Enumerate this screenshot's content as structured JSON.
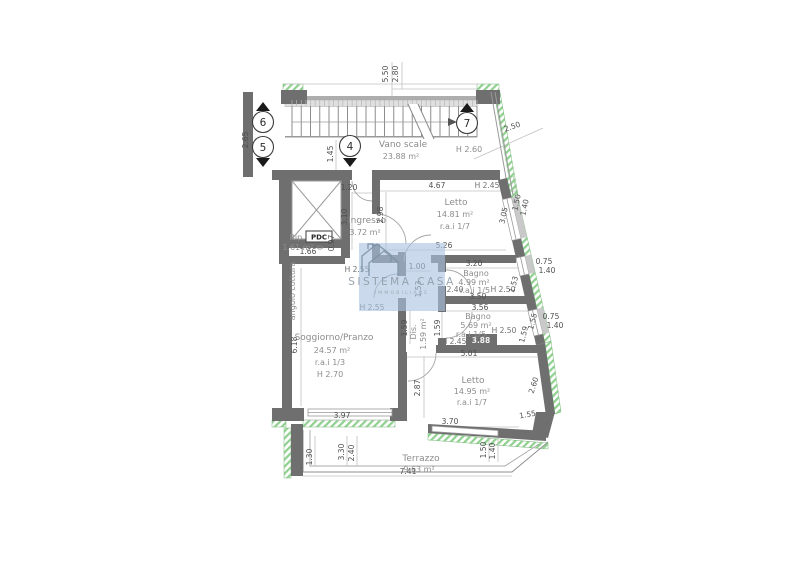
{
  "watermark": {
    "title": "SISTEMA CASA",
    "subtitle": "IMMOBILIARE"
  },
  "colors": {
    "wall": "#6f6f6f",
    "hatch_green": "#8fd08f",
    "watermark_bg": "#aac3e0",
    "dim_text": "#4f4f4f",
    "room_text": "#8c8c8c"
  },
  "stair": {
    "markers": [
      "6",
      "5",
      "4",
      "7"
    ]
  },
  "rooms": {
    "vano_scale": {
      "name": "Vano scale",
      "area": "23.88 m²",
      "height": "H 2.60"
    },
    "ingresso": {
      "name": "Ingresso",
      "area": "3.72 m²"
    },
    "rip": {
      "name": "Rip.",
      "area": "1.61 m²"
    },
    "pdc_label": "PDC",
    "angolo_cottura": "angolo cottura",
    "letto1": {
      "name": "Letto",
      "area": "14.81 m²",
      "rai": "r.a.i 1/7"
    },
    "bagno1": {
      "name": "Bagno",
      "area": "4.99 m²",
      "rai": "r.a.i 1/5"
    },
    "bagno2": {
      "name": "Bagno",
      "area": "5.69 m²",
      "rai": "r.a.i 1/5"
    },
    "dis": {
      "name": "Dis.",
      "area": "1.59 m²"
    },
    "soggiorno": {
      "name": "Soggiorno/Pranzo",
      "area": "24.57 m²",
      "rai": "r.a.i 1/3",
      "height": "H 2.70"
    },
    "letto2": {
      "name": "Letto",
      "area": "14.95 m²",
      "rai": "r.a.i 1/7"
    },
    "terrazzo": {
      "name": "Terrazzo",
      "area": "9.63 m²"
    }
  },
  "dims": [
    {
      "t": "5.50",
      "x": 388,
      "y": 74,
      "r": -90
    },
    {
      "t": "2.80",
      "x": 398,
      "y": 74,
      "r": -90
    },
    {
      "t": "2.65",
      "x": 248,
      "y": 140,
      "r": -90
    },
    {
      "t": "1.45",
      "x": 333,
      "y": 154,
      "r": -90
    },
    {
      "t": "2.50",
      "x": 513,
      "y": 129,
      "r": -19
    },
    {
      "t": "1.20",
      "x": 349,
      "y": 190
    },
    {
      "t": "4.67",
      "x": 437,
      "y": 188
    },
    {
      "t": "H 2.45",
      "x": 487,
      "y": 188,
      "c": "h"
    },
    {
      "t": "2.98",
      "x": 383,
      "y": 215,
      "r": -90
    },
    {
      "t": "3.05",
      "x": 506,
      "y": 216,
      "r": -78
    },
    {
      "t": "1.50",
      "x": 519,
      "y": 203,
      "r": -78
    },
    {
      "t": "1.40",
      "x": 527,
      "y": 208,
      "r": -78
    },
    {
      "t": "3.10",
      "x": 347,
      "y": 217,
      "r": -90
    },
    {
      "t": "1.66",
      "x": 308,
      "y": 254
    },
    {
      "t": "0.97",
      "x": 334,
      "y": 243,
      "r": -90
    },
    {
      "t": "5.26",
      "x": 444,
      "y": 248
    },
    {
      "t": "1.00",
      "x": 417,
      "y": 269
    },
    {
      "t": "3.20",
      "x": 474,
      "y": 266
    },
    {
      "t": "H 2.40",
      "x": 451,
      "y": 292,
      "c": "h"
    },
    {
      "t": "H 2.50",
      "x": 503,
      "y": 292,
      "c": "h"
    },
    {
      "t": "3.50",
      "x": 478,
      "y": 299
    },
    {
      "t": "0.75",
      "x": 544,
      "y": 264
    },
    {
      "t": "1.40",
      "x": 547,
      "y": 273
    },
    {
      "t": "1.53",
      "x": 516,
      "y": 285,
      "r": -75
    },
    {
      "t": "1.53",
      "x": 421,
      "y": 289,
      "r": -90
    },
    {
      "t": "H 2.55",
      "x": 357,
      "y": 272,
      "c": "h"
    },
    {
      "t": "H 2.55",
      "x": 372,
      "y": 310,
      "c": "h"
    },
    {
      "t": "3.56",
      "x": 480,
      "y": 310
    },
    {
      "t": "H 2.50",
      "x": 504,
      "y": 333,
      "c": "h"
    },
    {
      "t": "H 2.45",
      "x": 454,
      "y": 344,
      "c": "h"
    },
    {
      "t": "3.88",
      "x": 481,
      "y": 343,
      "c": "onwall"
    },
    {
      "t": "5.01",
      "x": 469,
      "y": 356
    },
    {
      "t": "1.59",
      "x": 407,
      "y": 328,
      "r": -90
    },
    {
      "t": "1.59",
      "x": 440,
      "y": 328,
      "r": -90
    },
    {
      "t": "1.55",
      "x": 535,
      "y": 322,
      "r": -75
    },
    {
      "t": "1.59",
      "x": 526,
      "y": 335,
      "r": -75
    },
    {
      "t": "0.75",
      "x": 551,
      "y": 319
    },
    {
      "t": "1.40",
      "x": 555,
      "y": 328
    },
    {
      "t": "6.18",
      "x": 297,
      "y": 345,
      "r": -90
    },
    {
      "t": "2.87",
      "x": 420,
      "y": 388,
      "r": -90
    },
    {
      "t": "2.60",
      "x": 536,
      "y": 386,
      "r": -72
    },
    {
      "t": "3.97",
      "x": 342,
      "y": 418
    },
    {
      "t": "3.70",
      "x": 450,
      "y": 424
    },
    {
      "t": "1.55",
      "x": 528,
      "y": 417,
      "r": -10
    },
    {
      "t": "1.30",
      "x": 312,
      "y": 457,
      "r": -90
    },
    {
      "t": "3.30",
      "x": 344,
      "y": 452,
      "r": -90
    },
    {
      "t": "2.40",
      "x": 354,
      "y": 453,
      "r": -90
    },
    {
      "t": "1.50",
      "x": 486,
      "y": 450,
      "r": -90
    },
    {
      "t": "1.40",
      "x": 495,
      "y": 451,
      "r": -90
    },
    {
      "t": "7.41",
      "x": 408,
      "y": 474
    }
  ]
}
